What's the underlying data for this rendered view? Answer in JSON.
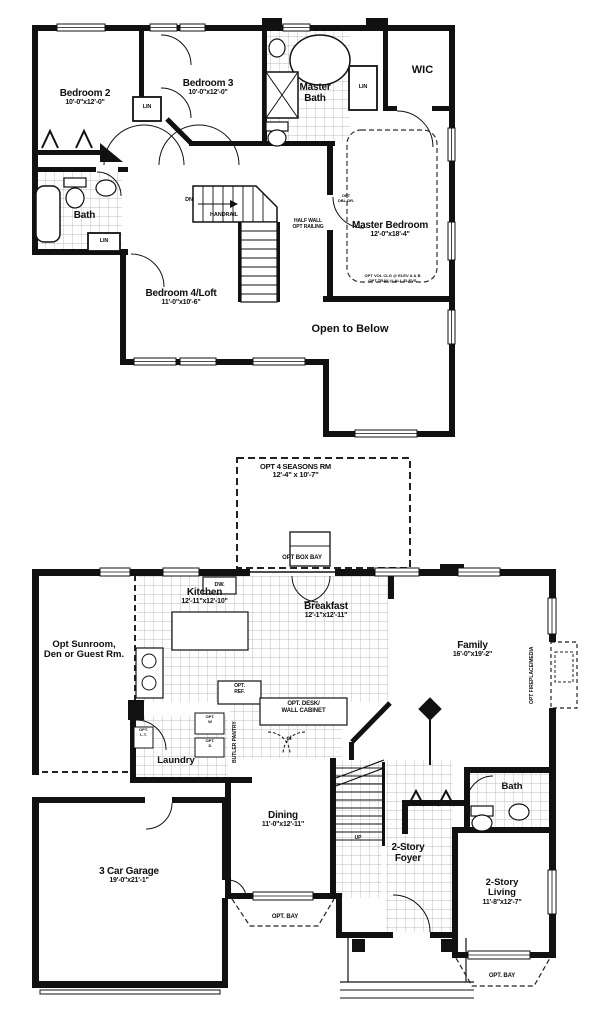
{
  "plan": {
    "upper": {
      "bedroom2": {
        "name": "Bedroom 2",
        "dims": "10'-0\"x12'-0\""
      },
      "bedroom3": {
        "name": "Bedroom 3",
        "dims": "10'-0\"x12'-0\""
      },
      "master_bath": {
        "name": "Master Bath"
      },
      "wic": {
        "name": "WIC"
      },
      "master_bedroom": {
        "name": "Master Bedroom",
        "dims": "12'-0\"x18'-4\"",
        "opt_door_line1": "OPT",
        "opt_door_line2": "DBL DR.",
        "note_line1": "OPT VOL CLG @ ELEV A & B",
        "note_line2": "OPT TRAY @ ALL ELEVS"
      },
      "bath": {
        "name": "Bath"
      },
      "bedroom4": {
        "name": "Bedroom 4/Loft",
        "dims": "11'-0\"x10'-6\""
      },
      "open_below": "Open to Below",
      "lin": "LIN",
      "dn": "DN",
      "handrail": "HANDRAIL",
      "half_wall_line1": "HALF WALL",
      "half_wall_line2": "OPT RAILING"
    },
    "lower": {
      "opt_seasons": {
        "name": "OPT 4 SEASONS RM",
        "dims": "12'-4\" x 10'-7\""
      },
      "opt_box_bay": "OPT BOX BAY",
      "kitchen": {
        "name": "Kitchen",
        "dims": "12'-11\"x12'-10\""
      },
      "dw": "DW.",
      "breakfast": {
        "name": "Breakfast",
        "dims": "12'-1\"x12'-11\""
      },
      "opt_ref": {
        "line1": "OPT.",
        "line2": "REF."
      },
      "sunroom": {
        "line1": "Opt Sunroom,",
        "line2": "Den or Guest Rm."
      },
      "family": {
        "name": "Family",
        "dims": "16'-0\"x19'-2\""
      },
      "opt_fireplace": "OPT FIREPLACE/MEDIA",
      "laundry": "Laundry",
      "opt_w": {
        "line1": "OPT.",
        "line2": "W"
      },
      "opt_d": {
        "line1": "OPT.",
        "line2": "D"
      },
      "opt_lt": {
        "line1": "OPT.",
        "line2": "L.T."
      },
      "butler_pantry": "BUTLER PANTRY",
      "opt_desk": {
        "line1": "OPT. DESK/",
        "line2": "WALL CABINET"
      },
      "cl": "cl",
      "up": "UP",
      "dining": {
        "name": "Dining",
        "dims": "11'-0\"x12'-11\""
      },
      "foyer": {
        "line1": "2-Story",
        "line2": "Foyer"
      },
      "bath": "Bath",
      "living": {
        "line1": "2-Story",
        "line2": "Living",
        "dims": "11'-8\"x12'-7\""
      },
      "garage": {
        "name": "3 Car Garage",
        "dims": "19'-0\"x21'-1\""
      },
      "opt_bay": "OPT. BAY"
    },
    "colors": {
      "wall": "#111111",
      "tile_line": "#9a9a9a",
      "paper": "#fefefe"
    }
  }
}
